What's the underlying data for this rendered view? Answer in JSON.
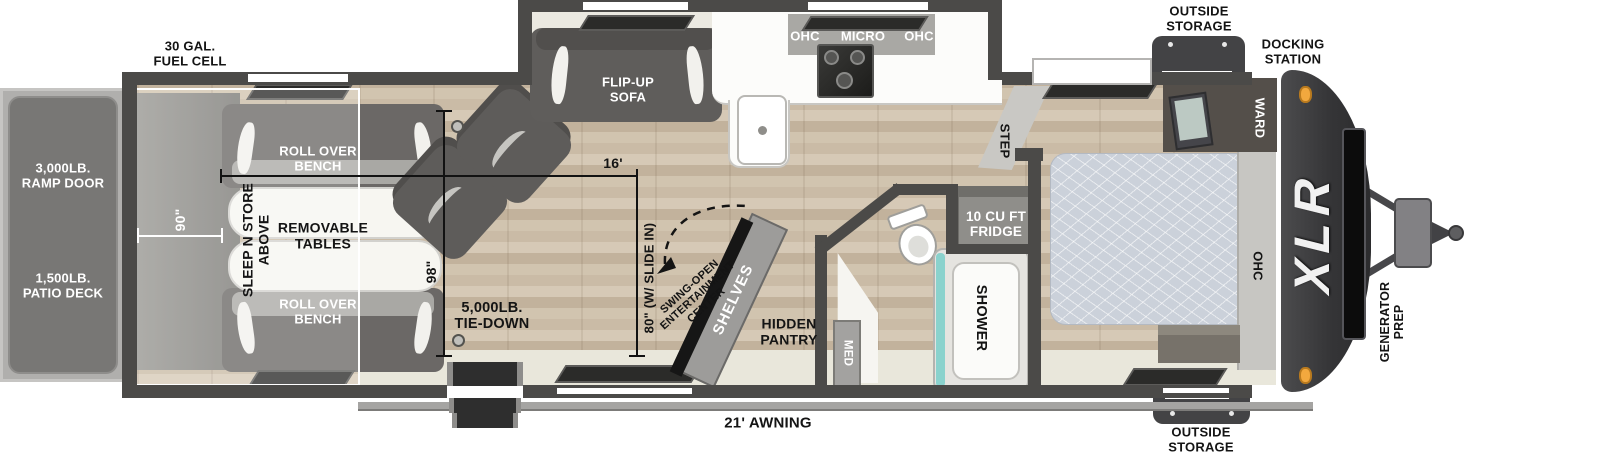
{
  "meta": {
    "title": "XLR Toy Hauler Travel Trailer Floor Plan"
  },
  "colors": {
    "wall": "#4b4a48",
    "front_cap": "#3a3a3c",
    "marker_light_orange": "#f2a83e",
    "shower_teal": "#8ad2cd",
    "floor_wood": "#cdbfa9",
    "floor_vinyl": "#e9e7db",
    "ramp_panel": "#787775"
  },
  "labels": {
    "fuel_cell": "30 GAL.\nFUEL CELL",
    "outside_storage_top": "OUTSIDE\nSTORAGE",
    "docking_station": "DOCKING\nSTATION",
    "outside_storage_bottom": "OUTSIDE\nSTORAGE",
    "ramp_door": "3,000LB.\nRAMP DOOR",
    "patio_deck": "1,500LB.\nPATIO DECK",
    "awning": "21' AWNING",
    "brand": "XLR",
    "generator_prep": "GENERATOR\nPREP",
    "roll_over_bench_top": "ROLL OVER\nBENCH",
    "roll_over_bench_bottom": "ROLL OVER\nBENCH",
    "removable_tables": "REMOVABLE\nTABLES",
    "sleep_n_store": "SLEEP N STORE\nABOVE",
    "tie_down": "5,000LB.\nTIE-DOWN",
    "flip_up_sofa": "FLIP-UP\nSOFA",
    "swing_open": "SWING-OPEN\nENTERTAINMENT\nCENTER",
    "shelves": "SHELVES",
    "hidden_pantry": "HIDDEN\nPANTRY",
    "ohc_left": "OHC",
    "micro": "MICRO",
    "ohc_right": "OHC",
    "shower": "SHOWER",
    "med": "MED",
    "fridge": "10 CU FT\nFRIDGE",
    "step": "STEP",
    "ward": "WARD",
    "ohc_bed": "OHC"
  },
  "dimensions": {
    "garage_width": "90\"",
    "cargo_length": "16'",
    "floor_width": "98\"",
    "slide_in_length": "80\" (W/ SLIDE IN)"
  }
}
